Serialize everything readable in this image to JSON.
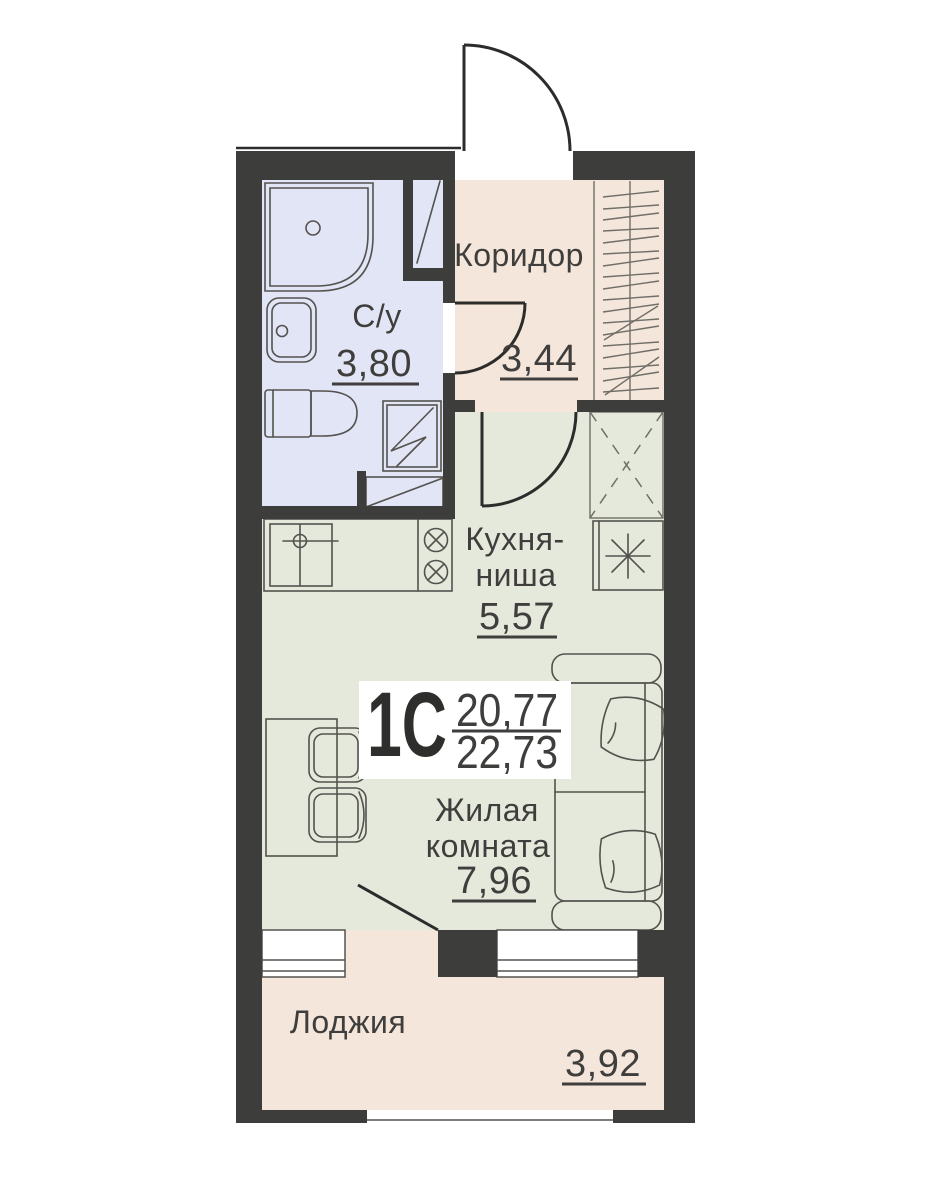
{
  "plan": {
    "apartment_type": "1С",
    "living_area": "20,77",
    "total_area": "22,73",
    "rooms": {
      "corridor": {
        "name": "Коридор",
        "area": "3,44"
      },
      "bathroom": {
        "name": "С/у",
        "area": "3,80"
      },
      "kitchen": {
        "name_line1": "Кухня-",
        "name_line2": "ниша",
        "area": "5,57"
      },
      "living": {
        "name_line1": "Жилая",
        "name_line2": "комната",
        "area": "7,96"
      },
      "loggia": {
        "name": "Лоджия",
        "area": "3,92"
      }
    }
  },
  "icons": {
    "shower": "shower-tray-icon",
    "sink": "sink-icon",
    "toilet": "toilet-icon",
    "washer": "washing-machine-icon",
    "stove": "stove-burners-icon",
    "fridge": "refrigerator-snowflake-icon",
    "wardrobe": "wardrobe-cross-icon",
    "coat_rack": "coat-rack-hatching-icon"
  },
  "colors": {
    "wall": "#3d3d3b",
    "bathroom_fill": "#e2e5f5",
    "corridor_fill": "#f4e6db",
    "room_fill": "#e4e9dc",
    "loggia_fill": "#f4e6db",
    "line": "#54524e",
    "door": "#2c2c2a",
    "text": "#3f3e3c",
    "background": "#ffffff"
  }
}
